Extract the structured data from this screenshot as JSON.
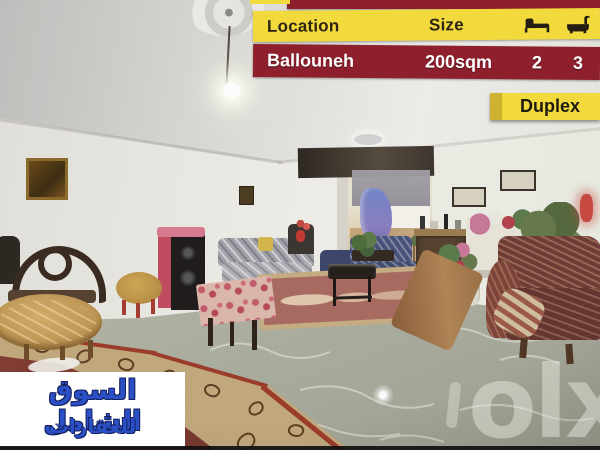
{
  "listing": {
    "header": {
      "location_label": "Location",
      "size_label": "Size"
    },
    "values": {
      "location": "Ballouneh",
      "size": "200sqm",
      "beds": "2",
      "baths": "3"
    },
    "type_badge": "Duplex"
  },
  "agency": {
    "name_line1": "السوق الشامل",
    "name_line2": "للعقارات"
  },
  "watermark": {
    "text": "olx"
  },
  "icons": {
    "beds": "bed-icon",
    "baths": "bathtub-icon"
  },
  "colors": {
    "banner_yellow": "#f2da3c",
    "banner_maroon": "#8e1f2c",
    "header_text": "#2e2414",
    "value_text": "#ffffff",
    "badge_yellow": "#f2da3c",
    "agency_blue": "#2b50c5",
    "agency_background": "#ffffff"
  }
}
